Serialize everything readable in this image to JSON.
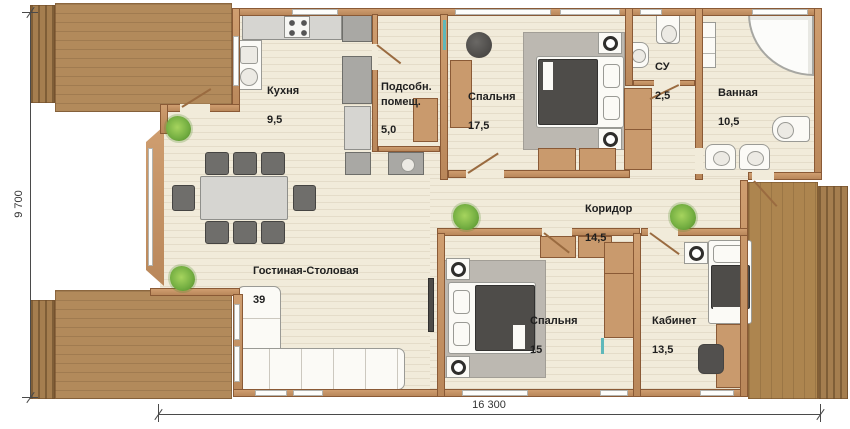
{
  "plan": {
    "type": "floor-plan",
    "language": "ru",
    "rooms": [
      {
        "id": "kitchen",
        "name": "Кухня",
        "area": "9,5"
      },
      {
        "id": "utility",
        "name": "Подсобн.\nпомещ.",
        "area": "5,0"
      },
      {
        "id": "bedroom1",
        "name": "Спальня",
        "area": "17,5"
      },
      {
        "id": "wc",
        "name": "СУ",
        "area": "2,5"
      },
      {
        "id": "bathroom",
        "name": "Ванная",
        "area": "10,5"
      },
      {
        "id": "corridor",
        "name": "Коридор",
        "area": "14,5"
      },
      {
        "id": "living",
        "name": "Гостиная-Столовая",
        "area": "39"
      },
      {
        "id": "bedroom2",
        "name": "Спальня",
        "area": "15"
      },
      {
        "id": "study",
        "name": "Кабинет",
        "area": "13,5"
      }
    ],
    "dimensions": {
      "width_label": "16 300",
      "height_label": "9 700"
    },
    "colors": {
      "wall": "#c0905f",
      "floor": "#f1ebda",
      "deck_wood": "#b28a5b",
      "furniture_dark": "#4e4c49",
      "rug": "#bcb8b1",
      "plant_green": "#76b043",
      "window_accent": "#5fb8ba"
    }
  }
}
